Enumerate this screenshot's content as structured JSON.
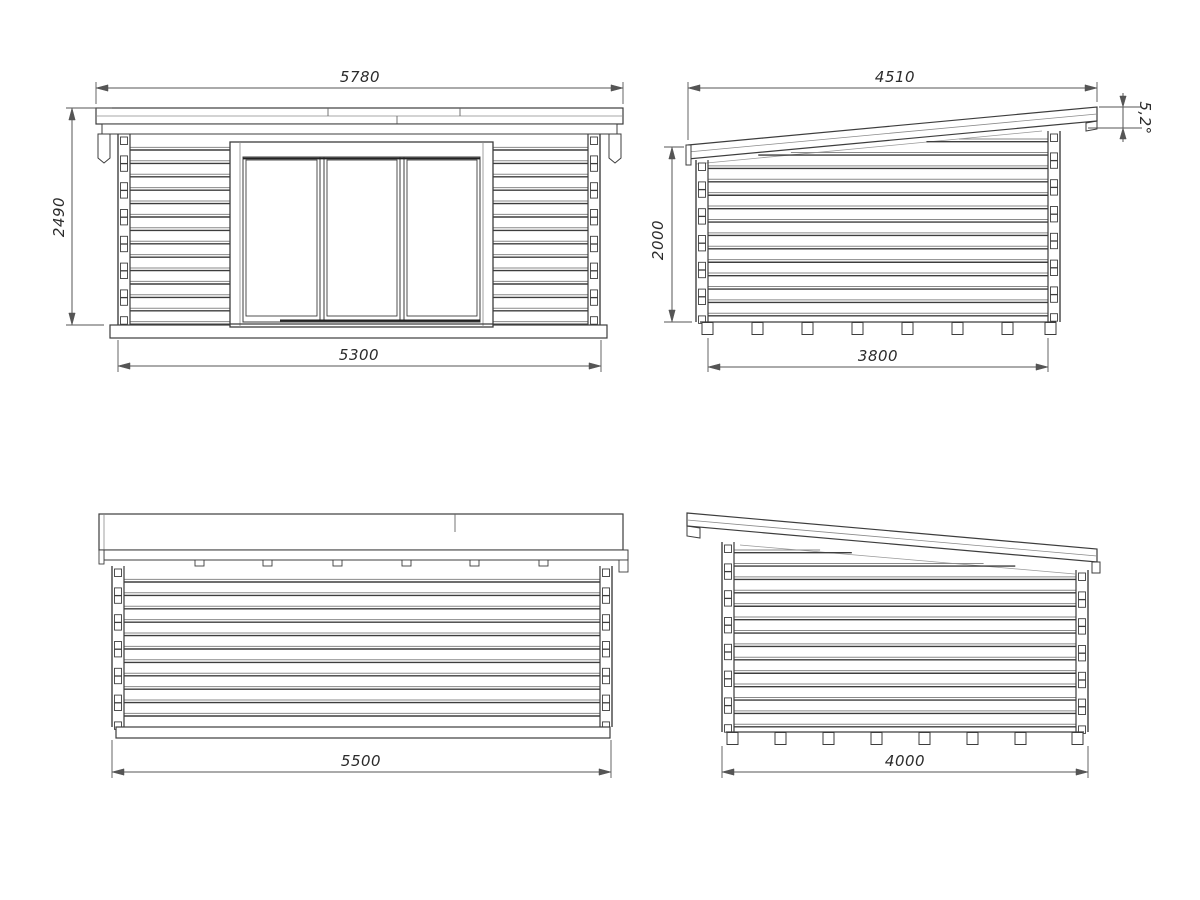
{
  "drawing": {
    "title": "log-cabin-elevation-drawing",
    "colors": {
      "background": "#ffffff",
      "line": "#3d3d3d",
      "light_line": "#8a8a8a",
      "dim_line": "#555555",
      "text": "#2b2b2b"
    },
    "views": {
      "front": {
        "name": "front elevation",
        "dims": {
          "roof_width": "5780",
          "total_height": "2490",
          "wall_width": "5300"
        }
      },
      "side_right": {
        "name": "side elevation (roof rising right)",
        "dims": {
          "roof_length": "4510",
          "roof_angle": "5,2°",
          "wall_height": "2000",
          "wall_length": "3800"
        }
      },
      "back": {
        "name": "back elevation",
        "dims": {
          "wall_width": "5500"
        }
      },
      "side_left": {
        "name": "side elevation (roof rising left)",
        "dims": {
          "wall_length": "4000"
        }
      }
    }
  }
}
